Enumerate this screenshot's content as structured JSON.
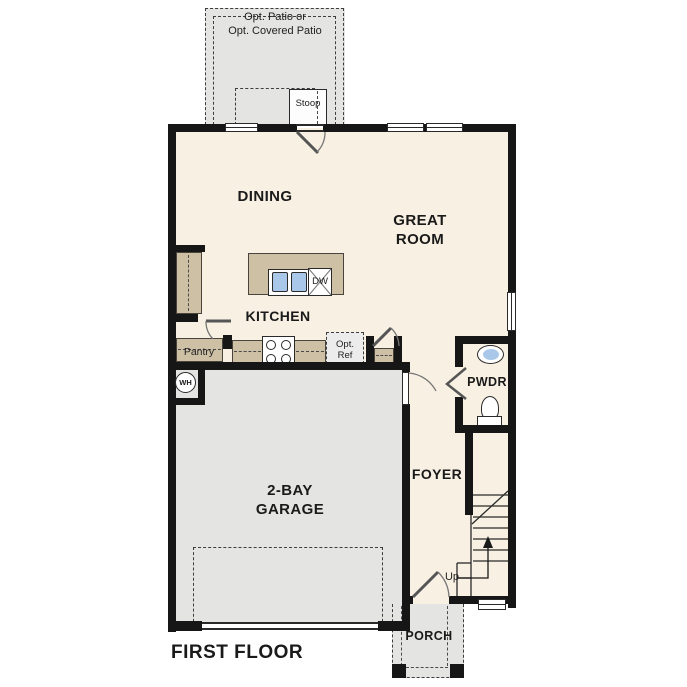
{
  "plan": {
    "title": "FIRST FLOOR",
    "labels": {
      "patio": "Opt. Patio or\nOpt. Covered Patio",
      "stoop": "Stoop",
      "dining": "DINING",
      "great_room": "GREAT\nROOM",
      "kitchen": "KITCHEN",
      "pantry": "Pantry",
      "opt_ref": "Opt.\nRef",
      "dishwasher": "DW",
      "water_heater": "WH",
      "garage": "2-BAY\nGARAGE",
      "foyer": "FOYER",
      "powder": "PWDR",
      "stairs_up": "Up",
      "porch": "PORCH"
    },
    "colors": {
      "floor": "#f8f0e2",
      "hardscape": "#e4e4e2",
      "cabinet": "#cec0a5",
      "wall": "#161616",
      "fixture_blue": "#a9c8e9",
      "optional_fill": "#ececec"
    }
  }
}
